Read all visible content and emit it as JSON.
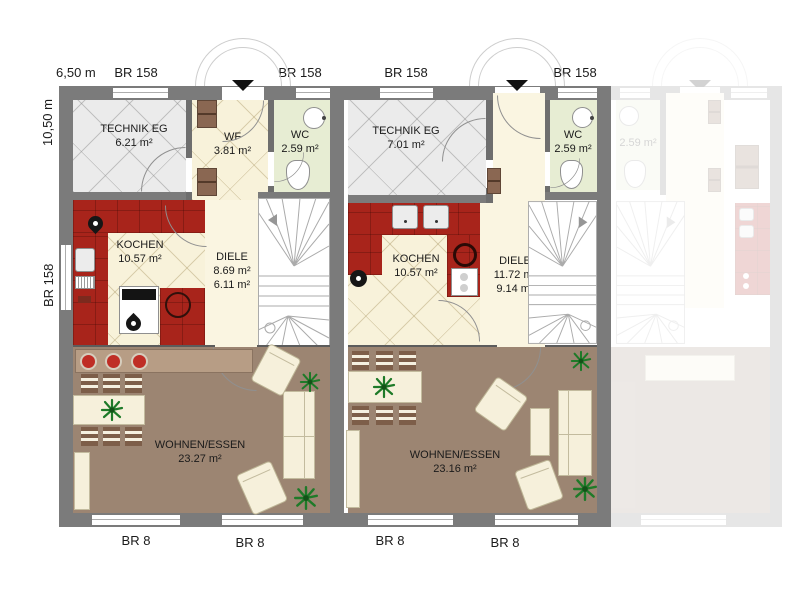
{
  "plan": {
    "dim_width": "6,50 m",
    "dim_height": "10,50 m",
    "left_window": "BR 158",
    "top_windows": [
      "BR 158",
      "BR 158",
      "BR 158",
      "BR 158"
    ],
    "bottom_windows": [
      "BR 8",
      "BR 8",
      "BR 8",
      "BR 8"
    ],
    "unit1": {
      "technik": {
        "name": "TECHNIK EG",
        "area": "6.21 m²"
      },
      "wf": {
        "name": "WF",
        "area": "3.81 m²"
      },
      "wc": {
        "name": "WC",
        "area": "2.59 m²"
      },
      "kochen": {
        "name": "KOCHEN",
        "area": "10.57 m²"
      },
      "diele": {
        "name": "DIELE",
        "area1": "8.69 m²",
        "area2": "6.11 m²"
      },
      "wohnen": {
        "name": "WOHNEN/ESSEN",
        "area": "23.27 m²"
      }
    },
    "unit2": {
      "technik": {
        "name": "TECHNIK EG",
        "area": "7.01 m²"
      },
      "wc": {
        "name": "WC",
        "area": "2.59 m²"
      },
      "kochen": {
        "name": "KOCHEN",
        "area": "10.57 m²"
      },
      "diele": {
        "name": "DIELE",
        "area1": "11.72 m²",
        "area2": "9.14 m²"
      },
      "wohnen": {
        "name": "WOHNEN/ESSEN",
        "area": "23.16 m²"
      }
    },
    "unit3": {
      "wc_area": "2.59 m²"
    },
    "colors": {
      "wall": "#7b7b7b",
      "kitchen_red": "#a8241b",
      "living_floor": "#9c8572",
      "sideboard": "#b79d85",
      "cream_floor": "#f8f2da",
      "technik_floor": "#ebebeb",
      "wc_floor": "#e7edd3",
      "furniture_cream": "#f6f0db",
      "chair_brown": "#7d5e49",
      "plant_green": "#1e7a28",
      "deco_bowl_red": "#bf2e26"
    }
  }
}
